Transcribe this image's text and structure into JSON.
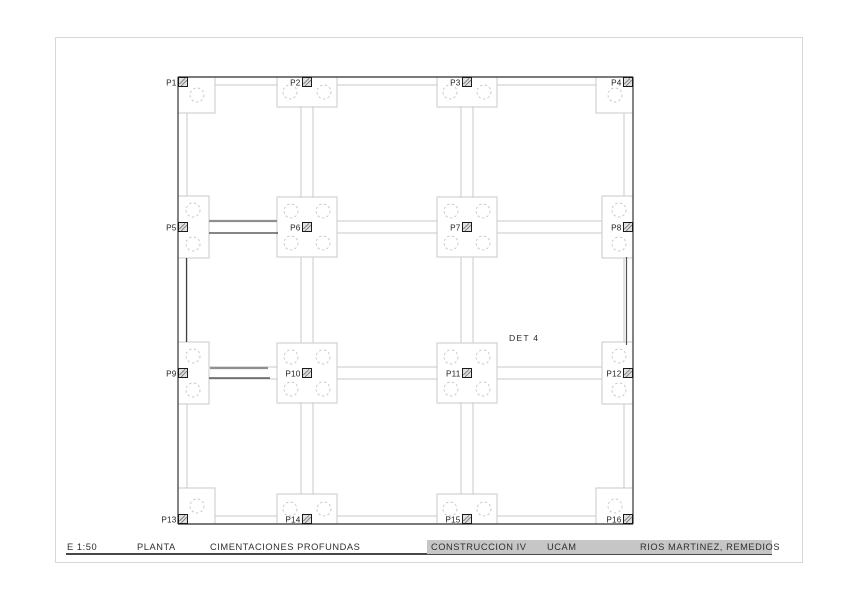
{
  "sheet": {
    "scale": "E 1:50",
    "view": "PLANTA",
    "title": "CIMENTACIONES PROFUNDAS",
    "course": "CONSTRUCCION IV",
    "institution": "UCAM",
    "author": "RIOS MARTINEZ, REMEDIOS",
    "titlebar_bg": "#c6c6c6"
  },
  "annotation": {
    "text": "DET 4",
    "x": 509,
    "y": 341
  },
  "plan": {
    "colors": {
      "light": "#c9c9c9",
      "dark": "#4f4f4f",
      "column_fill": "#e0e0e0",
      "column_edge": "#1a1a1a",
      "hatch": "#777777"
    },
    "col_x": [
      183,
      307,
      467,
      629
    ],
    "row_y": [
      81,
      227,
      373,
      520
    ],
    "perimeter": {
      "left": 178,
      "top": 77,
      "right": 633,
      "bottom": 524
    },
    "caps": [
      {
        "label": "P1",
        "col": 0,
        "row": 0,
        "type": "corner-tl"
      },
      {
        "label": "P2",
        "col": 1,
        "row": 0,
        "type": "edge-top"
      },
      {
        "label": "P3",
        "col": 2,
        "row": 0,
        "type": "edge-top"
      },
      {
        "label": "P4",
        "col": 3,
        "row": 0,
        "type": "corner-tr"
      },
      {
        "label": "P5",
        "col": 0,
        "row": 1,
        "type": "edge-left"
      },
      {
        "label": "P6",
        "col": 1,
        "row": 1,
        "type": "interior"
      },
      {
        "label": "P7",
        "col": 2,
        "row": 1,
        "type": "interior"
      },
      {
        "label": "P8",
        "col": 3,
        "row": 1,
        "type": "edge-right"
      },
      {
        "label": "P9",
        "col": 0,
        "row": 2,
        "type": "edge-left"
      },
      {
        "label": "P10",
        "col": 1,
        "row": 2,
        "type": "interior"
      },
      {
        "label": "P11",
        "col": 2,
        "row": 2,
        "type": "interior"
      },
      {
        "label": "P12",
        "col": 3,
        "row": 2,
        "type": "edge-right"
      },
      {
        "label": "P13",
        "col": 0,
        "row": 3,
        "type": "corner-bl"
      },
      {
        "label": "P14",
        "col": 1,
        "row": 3,
        "type": "edge-bottom"
      },
      {
        "label": "P15",
        "col": 2,
        "row": 3,
        "type": "edge-bottom"
      },
      {
        "label": "P16",
        "col": 3,
        "row": 3,
        "type": "corner-br"
      }
    ],
    "dark_segments": [
      {
        "x1": 209,
        "y1": 221,
        "x2": 277,
        "y2": 221,
        "w": 2.2,
        "c": "#8f8f8f"
      },
      {
        "x1": 209,
        "y1": 233,
        "x2": 278,
        "y2": 233,
        "w": 1.2,
        "c": "#3d3d3d"
      },
      {
        "x1": 210,
        "y1": 368,
        "x2": 268,
        "y2": 368,
        "w": 2.2,
        "c": "#8f8f8f"
      },
      {
        "x1": 209,
        "y1": 378,
        "x2": 270,
        "y2": 378,
        "w": 1.2,
        "c": "#3d3d3d"
      },
      {
        "x1": 186.5,
        "y1": 258,
        "x2": 186.5,
        "y2": 342,
        "w": 1.2,
        "c": "#3d3d3d"
      },
      {
        "x1": 626.5,
        "y1": 257,
        "x2": 626.5,
        "y2": 345,
        "w": 1.2,
        "c": "#555555"
      }
    ]
  }
}
